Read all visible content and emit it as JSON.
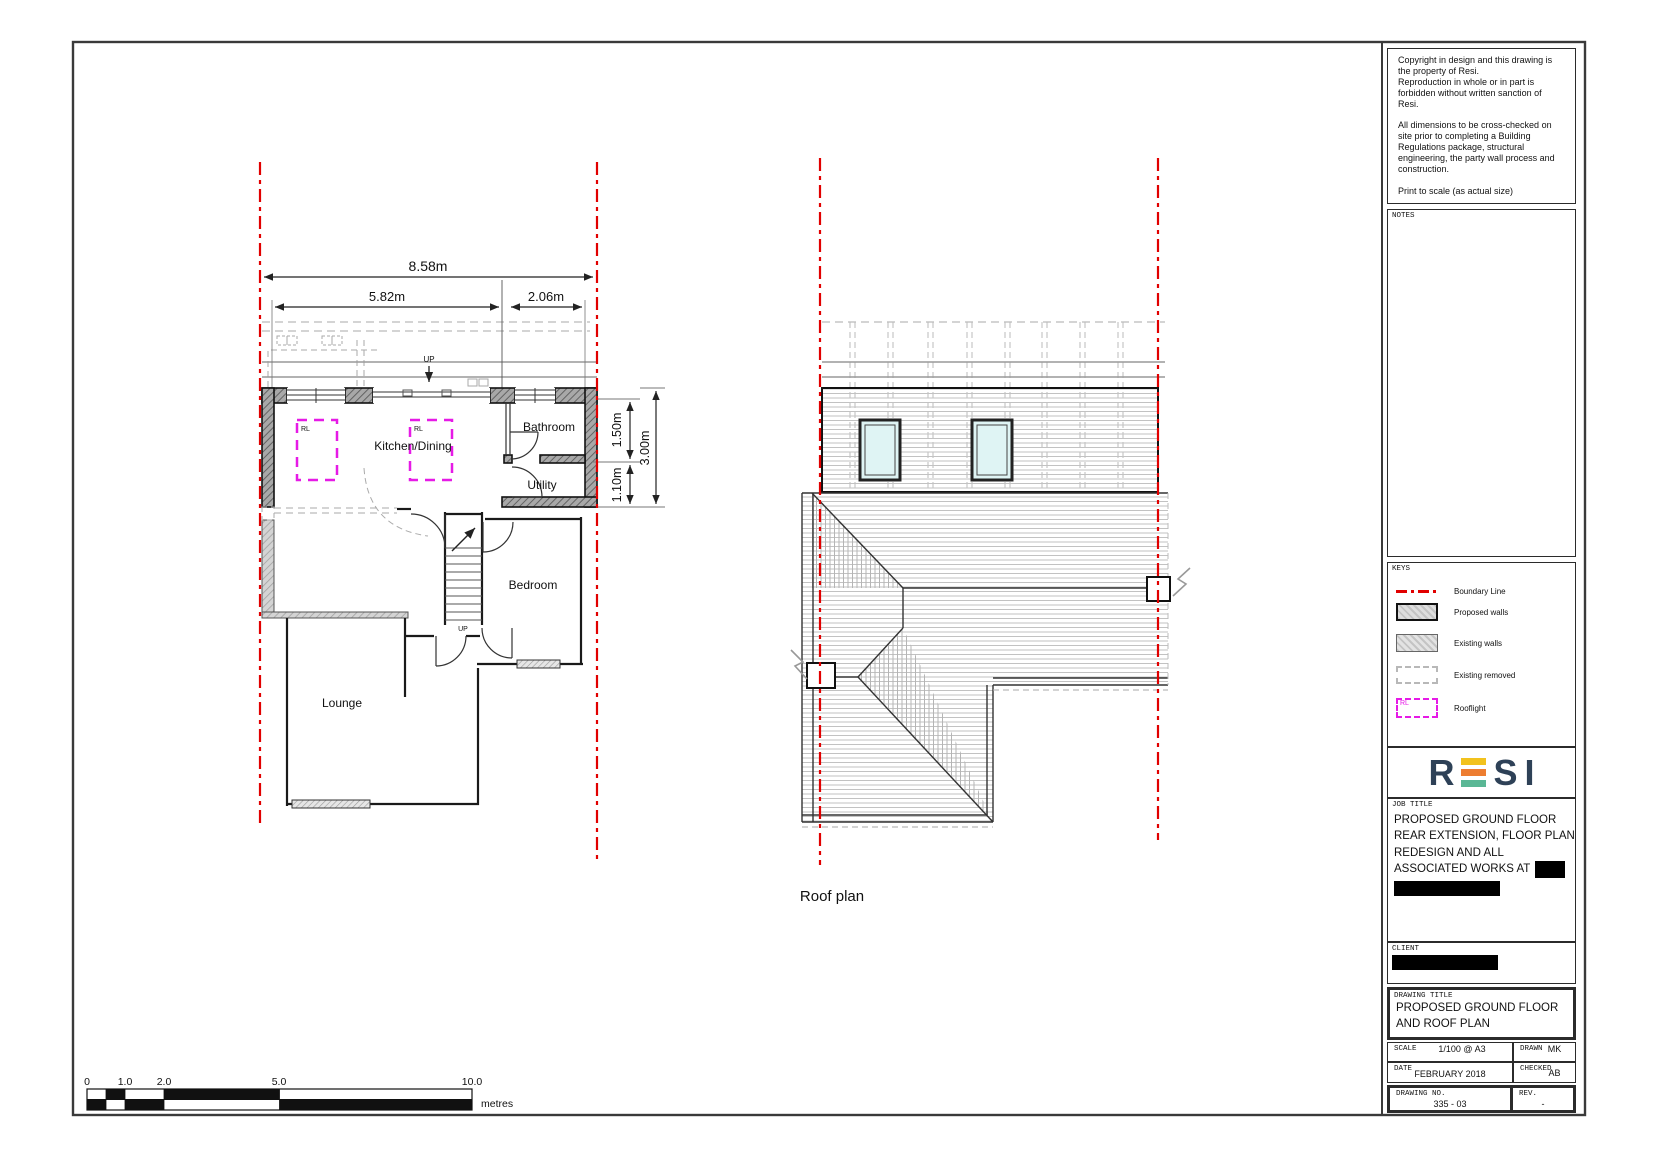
{
  "title_block": {
    "copyright_lines": [
      "Copyright in design and this drawing is",
      "the property of Resi.",
      "Reproduction in whole or in part is",
      "forbidden without written sanction of",
      "Resi.",
      "",
      "All dimensions to be cross-checked on",
      "site prior to completing a Building",
      "Regulations package, structural",
      "engineering, the party wall process and",
      "construction.",
      "",
      "Print to scale (as actual size)"
    ],
    "notes_label": "NOTES",
    "keys": {
      "label": "KEYS",
      "items": [
        "Boundary Line",
        "Proposed walls",
        "Existing walls",
        "Existing removed",
        "Rooflight"
      ],
      "rooflight_tag": "RL"
    },
    "logo": {
      "r": "R",
      "s": "S",
      "i": "I"
    },
    "job_title": {
      "label": "JOB TITLE",
      "lines": [
        "PROPOSED GROUND FLOOR",
        "REAR EXTENSION, FLOOR PLAN",
        "REDESIGN AND ALL",
        "ASSOCIATED WORKS AT"
      ]
    },
    "client_label": "CLIENT",
    "drawing_title": {
      "label": "DRAWING TITLE",
      "lines": [
        "PROPOSED GROUND FLOOR",
        "AND ROOF PLAN"
      ]
    },
    "fields": {
      "scale_label": "SCALE",
      "scale_value": "1/100 @ A3",
      "drawn_label": "DRAWN",
      "drawn_value": "MK",
      "date_label": "DATE",
      "date_value": "FEBRUARY 2018",
      "checked_label": "CHECKED",
      "checked_value": "AB",
      "drawing_no_label": "DRAWING NO.",
      "drawing_no_value": "335 - 03",
      "rev_label": "REV.",
      "rev_value": "-"
    }
  },
  "floor_plan": {
    "rooms": {
      "kitchen": "Kitchen/Dining",
      "bathroom": "Bathroom",
      "utility": "Utility",
      "bedroom": "Bedroom",
      "lounge": "Lounge"
    },
    "dimensions": {
      "overall": "8.58m",
      "left": "5.82m",
      "right": "2.06m",
      "depth_top": "1.50m",
      "depth_bottom": "1.10m",
      "depth_total": "3.00m"
    },
    "up_label": "UP",
    "rooflight_tag": "RL"
  },
  "roof_plan": {
    "label": "Roof plan"
  },
  "scale_bar": {
    "ticks": [
      "0",
      "1.0",
      "2.0",
      "5.0",
      "10.0"
    ],
    "unit": "metres"
  },
  "colors": {
    "boundary_red": "#e10000",
    "rooflight_magenta": "#e61ae6",
    "logo_navy": "#2e4157",
    "logo_yellow": "#f2c21d",
    "logo_orange": "#ed7d31",
    "logo_teal": "#5ab795"
  }
}
